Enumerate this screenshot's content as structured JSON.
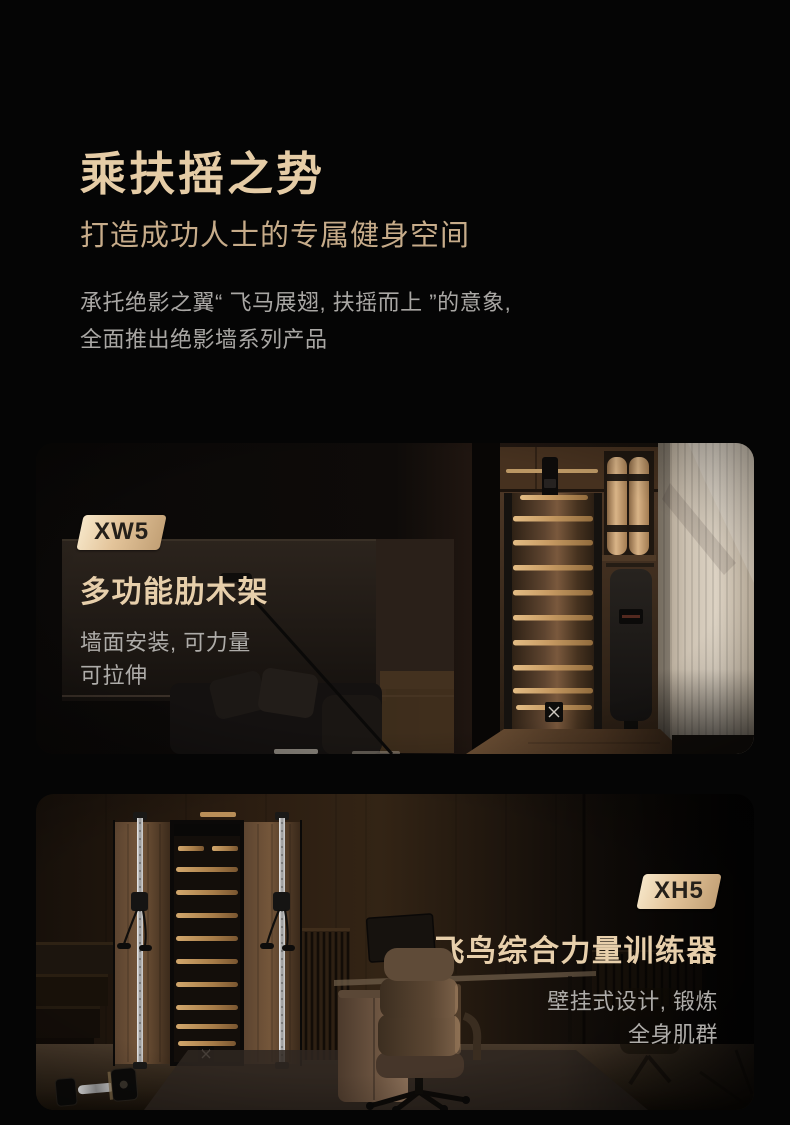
{
  "header": {
    "title": "乘扶摇之势",
    "subtitle": "打造成功人士的专属健身空间",
    "description_line1": "承托绝影之翼“ 飞马展翅, 扶摇而上 ”的意象,",
    "description_line2": "全面推出绝影墙系列产品"
  },
  "cards": [
    {
      "badge": "XW5",
      "title": "多功能肋木架",
      "desc_line1": "墙面安装, 可力量",
      "desc_line2": "可拉伸",
      "scene": "dark living room with wall-mounted wooden stall bars, rolled mats shelf, folded bench and beige curtain"
    },
    {
      "badge": "XH5",
      "title": "飞鸟综合力量训练器",
      "desc_line1": "壁挂式设计, 锻炼",
      "desc_line2": "全身肌群",
      "scene": "home office with wall-mounted cable crossover trainer, dumbbell on floor, desk and leather chair"
    }
  ],
  "colors": {
    "page_background": "#050505",
    "hero_title": "#e5cca6",
    "hero_subtitle": "#c7ac8a",
    "body_text": "#a9a7a4",
    "card_title": "#e7cfab",
    "card_desc": "#aeaca9",
    "badge_gradient_start": "#f6e6c8",
    "badge_gradient_end": "#c2a075",
    "badge_text": "#25201a"
  }
}
